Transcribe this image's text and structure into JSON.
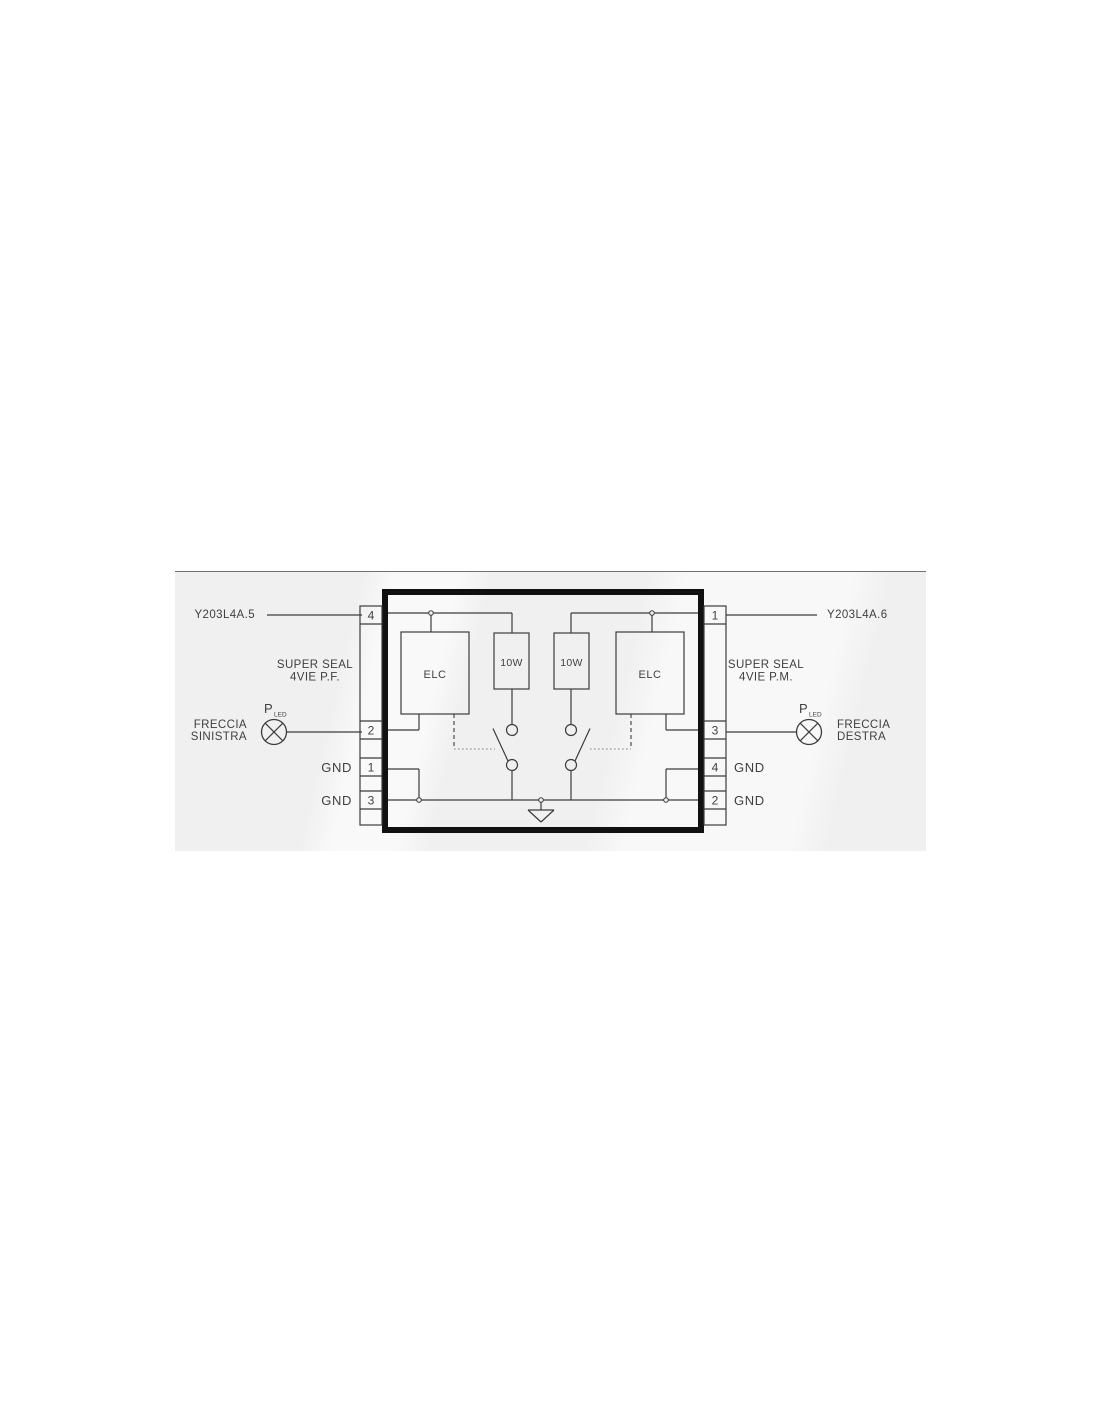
{
  "band": {
    "bg": "#f0f0f0",
    "top_rule_color": "#707070"
  },
  "colors": {
    "line": "#3c3c3c",
    "thick_border": "#111111",
    "text": "#3f3f3f",
    "dotted_link": "#9a9a9a"
  },
  "left": {
    "harness_label": "Y203L4A.5",
    "connector_line1": "SUPER SEAL",
    "connector_line2": "4VIE P.F.",
    "lamp_symbol_label": "P",
    "lamp_symbol_sub": "LED",
    "lamp_name_line1": "FRECCIA",
    "lamp_name_line2": "SINISTRA",
    "gnd_top": "GND",
    "gnd_bottom": "GND",
    "pins": [
      "4",
      "2",
      "1",
      "3"
    ]
  },
  "right": {
    "harness_label": "Y203L4A.6",
    "connector_line1": "SUPER SEAL",
    "connector_line2": "4VIE P.M.",
    "lamp_symbol_label": "P",
    "lamp_symbol_sub": "LED",
    "lamp_name_line1": "FRECCIA",
    "lamp_name_line2": "DESTRA",
    "gnd_top": "GND",
    "gnd_bottom": "GND",
    "pins": [
      "1",
      "3",
      "4",
      "2"
    ]
  },
  "unit": {
    "elc_left": "ELC",
    "elc_right": "ELC",
    "resistor_left": "10W",
    "resistor_right": "10W"
  }
}
